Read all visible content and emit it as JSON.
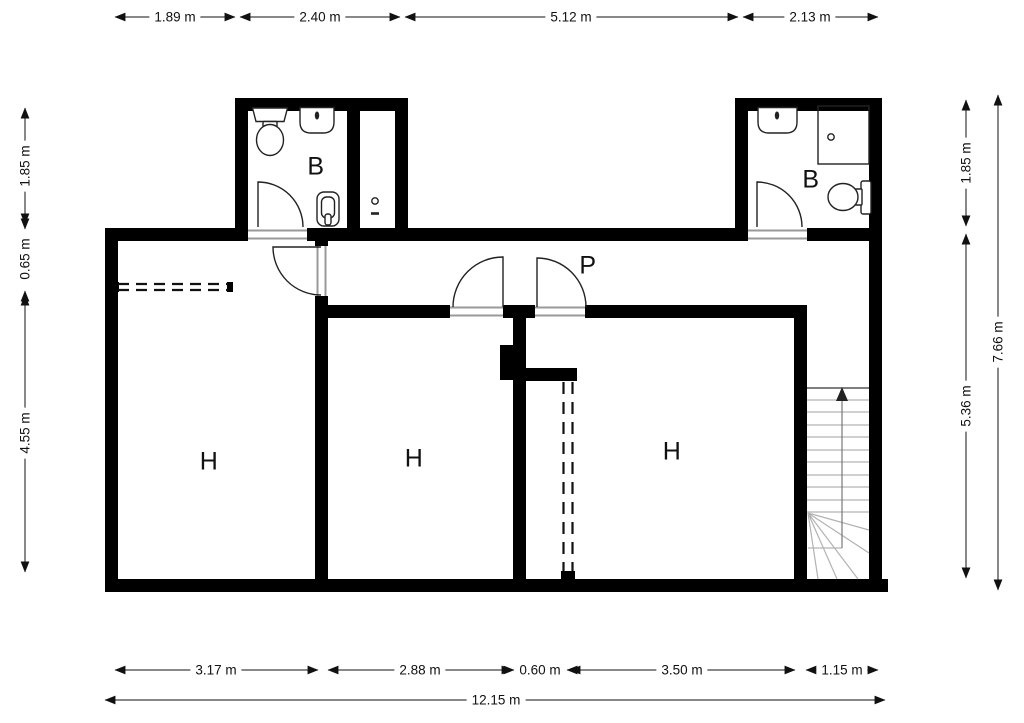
{
  "rooms": {
    "bathroom_left": "B",
    "bathroom_right": "B",
    "hallway": "P",
    "bedroom_left": "H",
    "bedroom_middle": "H",
    "bedroom_right": "H"
  },
  "dimensions": {
    "top": [
      "1.89 m",
      "2.40 m",
      "5.12 m",
      "2.13 m"
    ],
    "left": [
      "1.85 m",
      "0.65 m",
      "4.55 m"
    ],
    "right_inner": [
      "1.85 m",
      "5.36 m"
    ],
    "right_outer": "7.66 m",
    "bottom": [
      "3.17 m",
      "2.88 m",
      "0.60 m",
      "3.50 m",
      "1.15 m"
    ],
    "bottom_total": "12.15 m"
  },
  "colors": {
    "walls": "#000000",
    "background": "#ffffff",
    "fixture_stroke": "#222222",
    "threshold": "#999999",
    "stair_lines": "#b3b3b3",
    "dimension": "#111111"
  }
}
